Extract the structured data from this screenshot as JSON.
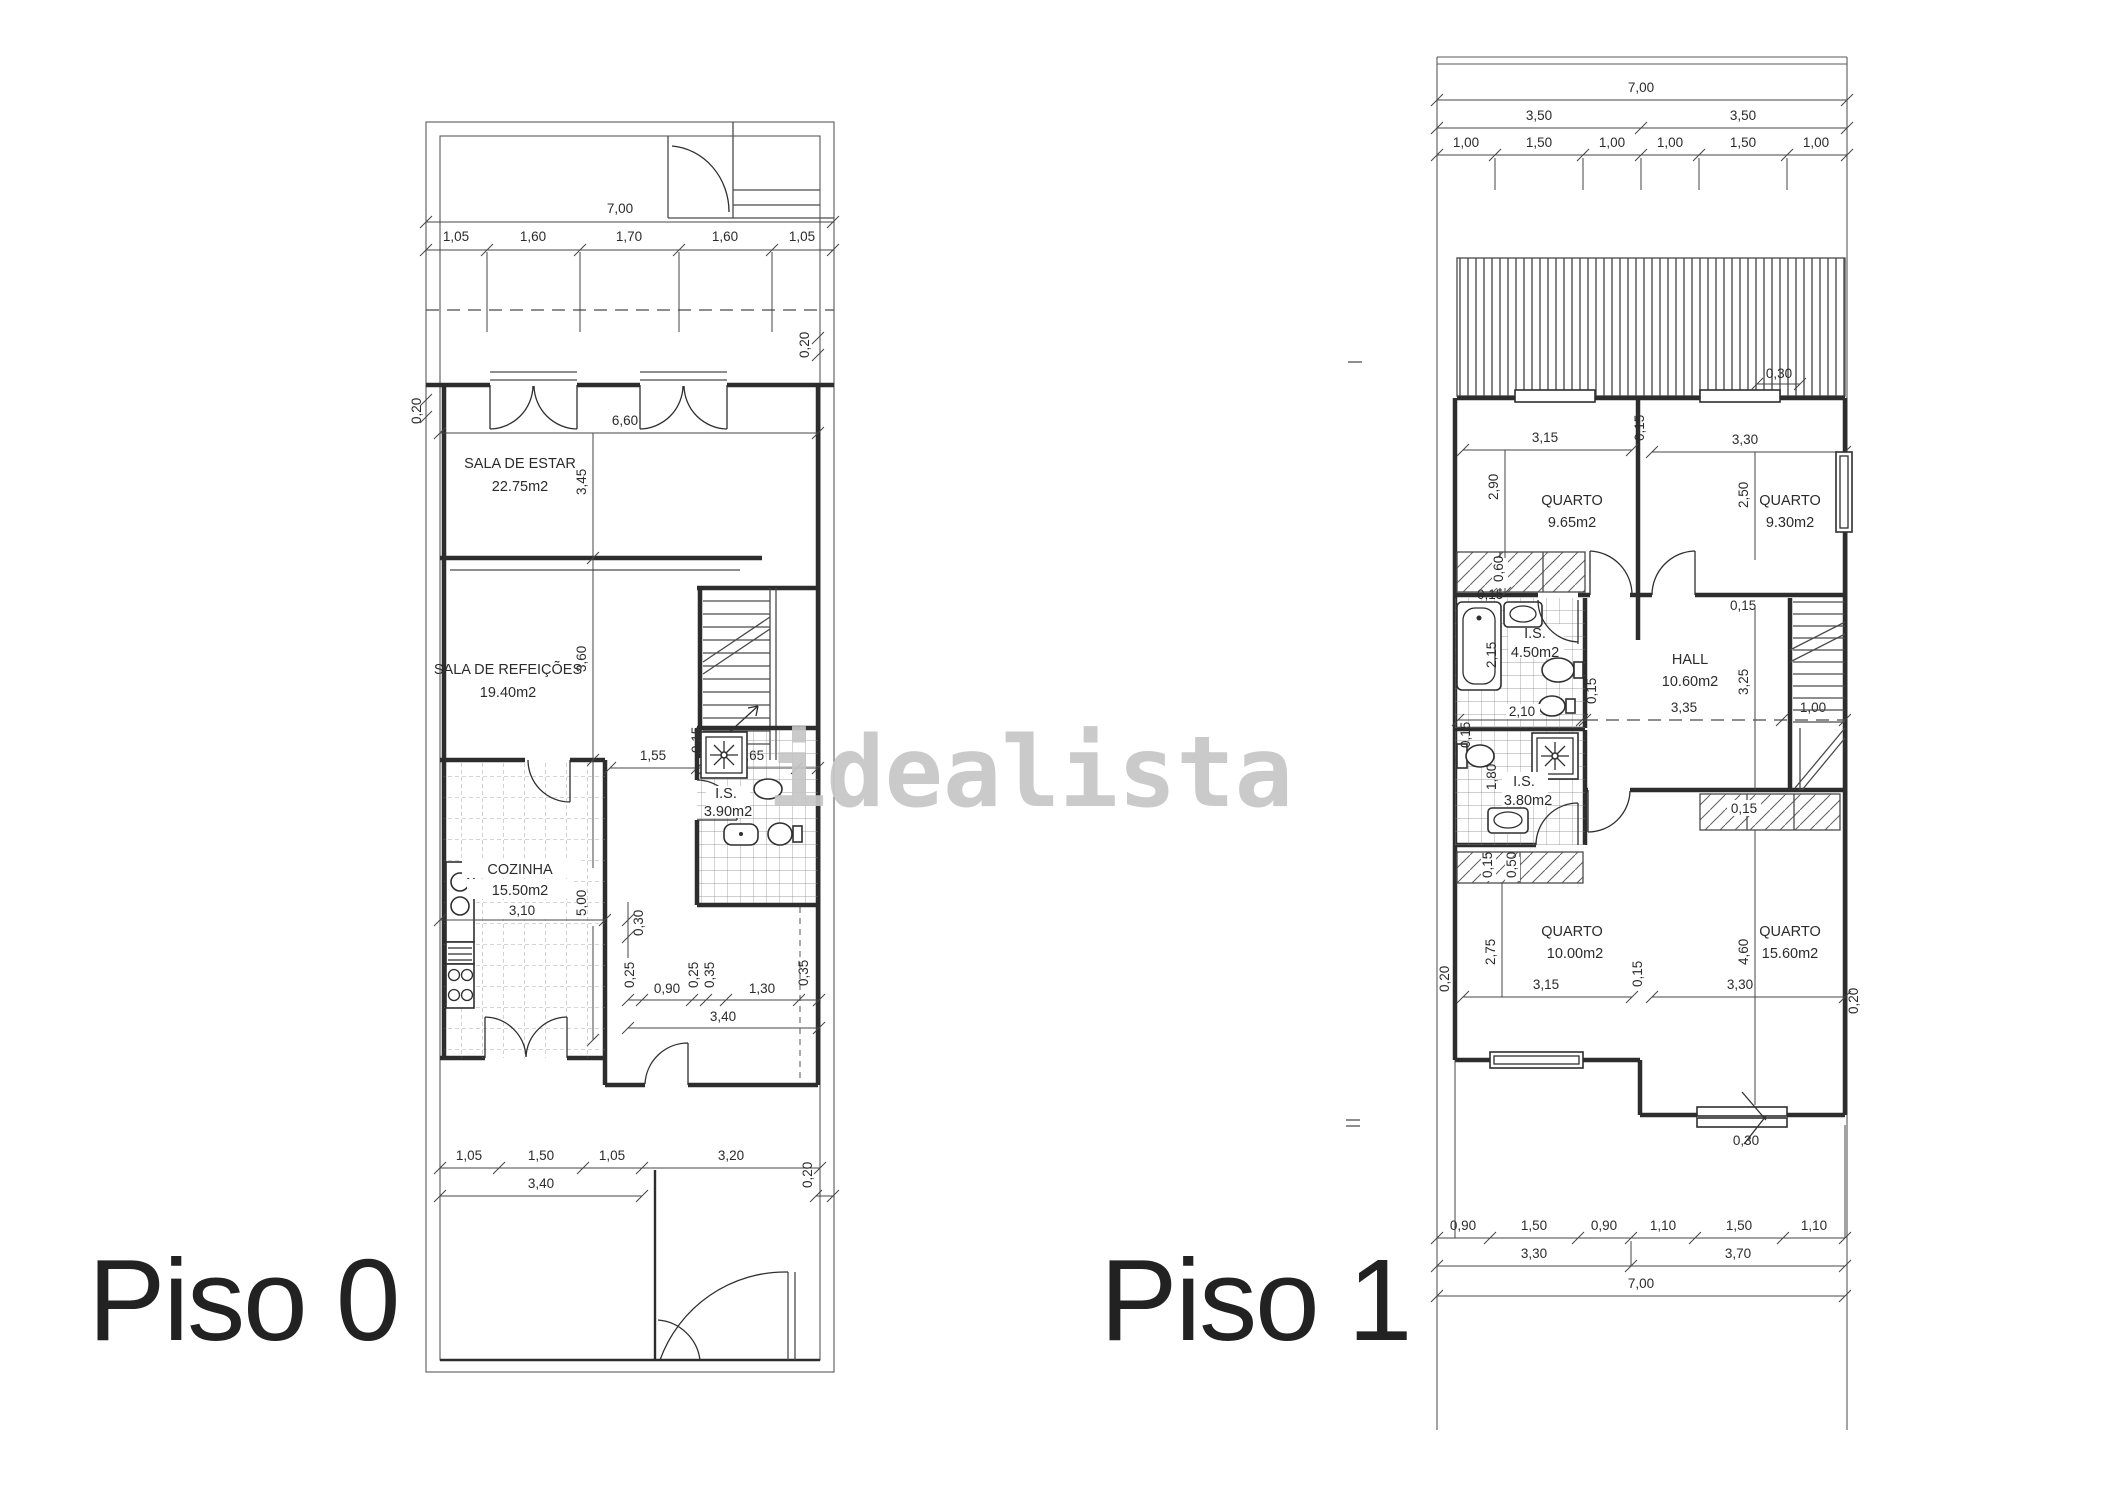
{
  "watermark": "idealista",
  "piso0": {
    "label": "Piso 0",
    "rooms": {
      "sala_estar": {
        "name": "SALA DE ESTAR",
        "area": "22.75m2"
      },
      "sala_refeicoes": {
        "name": "SALA DE REFEIÇÕES",
        "area": "19.40m2"
      },
      "cozinha": {
        "name": "COZINHA",
        "area": "15.50m2"
      },
      "is": {
        "name": "I.S.",
        "area": "3.90m2"
      }
    },
    "dims": {
      "width_total": "7,00",
      "top_segments": [
        "1,05",
        "1,60",
        "1,70",
        "1,60",
        "1,05"
      ],
      "wall_left": "0,20",
      "wall_right_top": "0,20",
      "sala_width": "6,60",
      "sala_depth": "3,45",
      "refeicoes_depth": "3,60",
      "hall_row": [
        "1,55",
        "0,15",
        "1,65"
      ],
      "cozinha_width": "3,10",
      "cozinha_depth": "5,00",
      "wall_mid": "0,30",
      "lower_row": [
        "0,25",
        "0,90",
        "0,25",
        "0,35",
        "1,30",
        "0,35"
      ],
      "lower_total": "3,40",
      "patio_segments": [
        "1,05",
        "1,50",
        "1,05",
        "3,20"
      ],
      "patio_left_total": "3,40",
      "wall_right_bottom": "0,20"
    }
  },
  "piso1": {
    "label": "Piso 1",
    "rooms": {
      "quarto1": {
        "name": "QUARTO",
        "area": "9.65m2"
      },
      "quarto2": {
        "name": "QUARTO",
        "area": "9.30m2"
      },
      "is1": {
        "name": "I.S.",
        "area": "4.50m2"
      },
      "hall": {
        "name": "HALL",
        "area": "10.60m2"
      },
      "is2": {
        "name": "I.S.",
        "area": "3.80m2"
      },
      "quarto3": {
        "name": "QUARTO",
        "area": "10.00m2"
      },
      "quarto4": {
        "name": "QUARTO",
        "area": "15.60m2"
      }
    },
    "dims": {
      "width_total": "7,00",
      "top_halves": [
        "3,50",
        "3,50"
      ],
      "top_segments": [
        "1,00",
        "1,50",
        "1,00",
        "1,00",
        "1,50",
        "1,00"
      ],
      "balcony_step": "0,30",
      "quarto1_width": "3,15",
      "quarto1_depth": "2,90",
      "wall_q1_q2": "0,15",
      "quarto2_width": "3,30",
      "quarto2_depth": "2,50",
      "closet1_depth": "0,60",
      "is1_wall": "0,15",
      "is1_depth": "2,15",
      "is1_width": "2,10",
      "is1_wall2": "0,15",
      "hall_wall": "0,15",
      "hall_width": "3,35",
      "hall_depth": "3,25",
      "stairs_width": "1,00",
      "is2_wall": "0,15",
      "is2_depth": "1,80",
      "is2_bottom": [
        "0,15",
        "0,50"
      ],
      "closet2_depth": "0,15",
      "quarto3_width": "3,15",
      "quarto3_depth": "2,75",
      "wall_q3_q4": "0,15",
      "quarto4_width": "3,30",
      "quarto4_depth": "4,60",
      "wall_right": "0,20",
      "wall_left": "0,20",
      "porch_width": "0,30",
      "bottom_segments": [
        "0,90",
        "1,50",
        "0,90",
        "1,10",
        "1,50",
        "1,10"
      ],
      "bottom_halves": [
        "3,30",
        "3,70"
      ],
      "bottom_total": "7,00"
    }
  }
}
